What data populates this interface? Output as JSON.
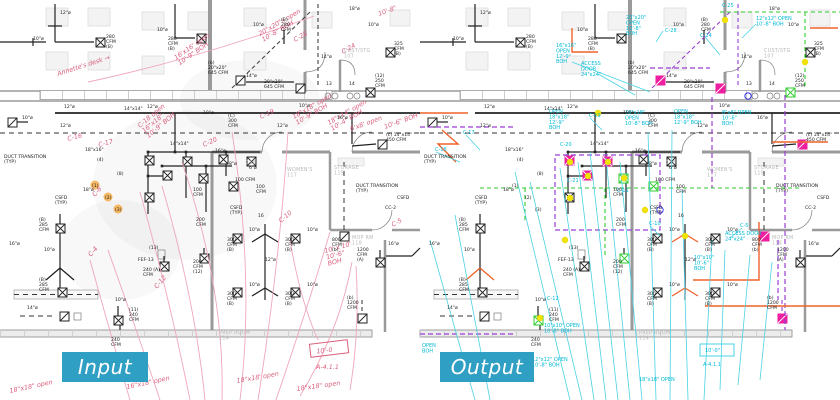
{
  "badges": {
    "input": "Input",
    "output": "Output"
  },
  "accent_color": "#2f9fc4",
  "palette": {
    "cyan": "#00b9d6",
    "magenta": "#ee1ea0",
    "green": "#2ecc2e",
    "purple": "#9a3fd4",
    "orange": "#f0622a",
    "yellow": "#f2e400",
    "markup_red": "#d95f7d",
    "walls_gray": "#9a9a9a"
  },
  "input_box_note": {
    "line1": "10'-0",
    "line2": "A-4.1.1"
  },
  "output_box_note": {
    "line1": "10'-0\"",
    "line2": "A-4.1.1"
  },
  "plan_labels": [
    {
      "x": 60,
      "y": 14,
      "t": "12\"ø"
    },
    {
      "x": 33,
      "y": 40,
      "t": "10\"ø"
    },
    {
      "x": 106,
      "y": 38,
      "t": "280\nCFM\n(B)"
    },
    {
      "x": 157,
      "y": 31,
      "t": "10\"ø"
    },
    {
      "x": 168,
      "y": 40,
      "t": "280\nCFM\n(B)"
    },
    {
      "x": 253,
      "y": 26,
      "t": "10\"ø"
    },
    {
      "x": 281,
      "y": 21,
      "t": "(B)\n280\nCFM"
    },
    {
      "x": 349,
      "y": 10,
      "t": "18\"ø"
    },
    {
      "x": 208,
      "y": 64,
      "t": "(b)\n20\"x20\"\n645 CFM"
    },
    {
      "x": 264,
      "y": 83,
      "t": "20\"x20\"\n645 CFM"
    },
    {
      "x": 246,
      "y": 77,
      "t": "14\"ø"
    },
    {
      "x": 321,
      "y": 58,
      "t": "14\"ø"
    },
    {
      "x": 394,
      "y": 45,
      "t": "325\nCFM\n(B)"
    },
    {
      "x": 375,
      "y": 77,
      "t": "(12)\n250\nCFM"
    },
    {
      "x": 326,
      "y": 85,
      "t": "13"
    },
    {
      "x": 349,
      "y": 85,
      "t": "14"
    },
    {
      "x": 368,
      "y": 26,
      "t": "10\"ø"
    },
    {
      "x": 344,
      "y": 52,
      "t": "CUST/STG\n107",
      "c": "rm"
    },
    {
      "x": 64,
      "y": 108,
      "t": "12\"ø"
    },
    {
      "x": 147,
      "y": 108,
      "t": "12\"ø"
    },
    {
      "x": 60,
      "y": 127,
      "t": "12\"ø"
    },
    {
      "x": 22,
      "y": 119,
      "t": "10\"ø"
    },
    {
      "x": 124,
      "y": 110,
      "t": "14\"x14\""
    },
    {
      "x": 203,
      "y": 114,
      "t": "10\"ø"
    },
    {
      "x": 228,
      "y": 117,
      "t": "(C)\n300\nCFM"
    },
    {
      "x": 277,
      "y": 127,
      "t": "12\"ø"
    },
    {
      "x": 299,
      "y": 107,
      "t": "10\"ø"
    },
    {
      "x": 337,
      "y": 119,
      "t": "16\"ø"
    },
    {
      "x": 386,
      "y": 136,
      "t": "(c) 14\"x14\"\n450 CFM"
    },
    {
      "x": 4,
      "y": 158,
      "t": "DUCT TRANSITION\n(TYP)"
    },
    {
      "x": 85,
      "y": 151,
      "t": "18\"x16\""
    },
    {
      "x": 170,
      "y": 145,
      "t": "14\"x14\""
    },
    {
      "x": 356,
      "y": 187,
      "t": "DUCT TRANSITION\n(TYP)"
    },
    {
      "x": 334,
      "y": 169,
      "t": "STORAGE\n115",
      "c": "rm"
    },
    {
      "x": 287,
      "y": 171,
      "t": "WOMEN'S\n117",
      "c": "rm"
    },
    {
      "x": 246,
      "y": 164,
      "t": "116",
      "c": "rm"
    },
    {
      "x": 55,
      "y": 199,
      "t": "CSFD\n(TYP)"
    },
    {
      "x": 230,
      "y": 209,
      "t": "CSFD\n(TYP)"
    },
    {
      "x": 258,
      "y": 217,
      "t": "16"
    },
    {
      "x": 397,
      "y": 199,
      "t": "CSFD"
    },
    {
      "x": 385,
      "y": 209,
      "t": "CC-2"
    },
    {
      "x": 215,
      "y": 152,
      "t": "16\"ø"
    },
    {
      "x": 229,
      "y": 165,
      "t": "8\"ø"
    },
    {
      "x": 249,
      "y": 169,
      "t": "6\"ø"
    },
    {
      "x": 235,
      "y": 181,
      "t": "100 CFM"
    },
    {
      "x": 256,
      "y": 188,
      "t": "100\nCFM"
    },
    {
      "x": 193,
      "y": 191,
      "t": "100\nCFM"
    },
    {
      "x": 138,
      "y": 261,
      "t": "FEF-13"
    },
    {
      "x": 39,
      "y": 221,
      "t": "(B)\n285\nCFM"
    },
    {
      "x": 44,
      "y": 251,
      "t": "10\"ø"
    },
    {
      "x": 9,
      "y": 245,
      "t": "16\"ø"
    },
    {
      "x": 39,
      "y": 281,
      "t": "(B)\n285\nCFM"
    },
    {
      "x": 83,
      "y": 191,
      "t": "18\"ø"
    },
    {
      "x": 27,
      "y": 309,
      "t": "14\"ø"
    },
    {
      "x": 115,
      "y": 301,
      "t": "10\"ø"
    },
    {
      "x": 129,
      "y": 311,
      "t": "(11)\n240\nCFM"
    },
    {
      "x": 111,
      "y": 341,
      "t": "240\nCFM"
    },
    {
      "x": 143,
      "y": 271,
      "t": "240 (A)\nCFM"
    },
    {
      "x": 193,
      "y": 263,
      "t": "200\nCFM\n(12)"
    },
    {
      "x": 196,
      "y": 221,
      "t": "200\nCFM"
    },
    {
      "x": 227,
      "y": 241,
      "t": "300\nCFM\n(B)"
    },
    {
      "x": 285,
      "y": 241,
      "t": "300\nCFM\n(B)"
    },
    {
      "x": 227,
      "y": 295,
      "t": "300\nCFM\n(B)"
    },
    {
      "x": 285,
      "y": 295,
      "t": "300\nCFM\n(B)"
    },
    {
      "x": 249,
      "y": 231,
      "t": "10\"ø"
    },
    {
      "x": 307,
      "y": 231,
      "t": "10\"ø"
    },
    {
      "x": 249,
      "y": 286,
      "t": "10\"ø"
    },
    {
      "x": 307,
      "y": 286,
      "t": "10\"ø"
    },
    {
      "x": 265,
      "y": 261,
      "t": "12\"ø"
    },
    {
      "x": 332,
      "y": 241,
      "t": "800\nCFM\n(b)"
    },
    {
      "x": 352,
      "y": 239,
      "t": "MOP RM\n118",
      "c": "rm"
    },
    {
      "x": 357,
      "y": 251,
      "t": "1200\nCFM\n(A)"
    },
    {
      "x": 388,
      "y": 245,
      "t": "16\"ø"
    },
    {
      "x": 347,
      "y": 299,
      "t": "(b)\n1200\nCFM"
    },
    {
      "x": 219,
      "y": 334,
      "t": "PREP ROOM\n114",
      "c": "rm"
    },
    {
      "x": 97,
      "y": 161,
      "t": "(4)"
    },
    {
      "x": 117,
      "y": 175,
      "t": "(8)"
    },
    {
      "x": 92,
      "y": 187,
      "t": "(1)"
    },
    {
      "x": 105,
      "y": 199,
      "t": "(2)"
    },
    {
      "x": 115,
      "y": 211,
      "t": "(3)"
    },
    {
      "x": 149,
      "y": 249,
      "t": "(13)"
    }
  ],
  "input_markup_notes": [
    {
      "x": 58,
      "y": 76,
      "t": "Annette's desk →",
      "r": -18
    },
    {
      "x": 176,
      "y": 60,
      "t": "16'x16' open\n10'-9\" BOH",
      "r": -35
    },
    {
      "x": 260,
      "y": 36,
      "t": "20\"x20\"s open\n10'-8\" BOH",
      "r": -30
    },
    {
      "x": 295,
      "y": 42,
      "t": "C-28",
      "r": -30
    },
    {
      "x": 343,
      "y": 54,
      "t": "C-24",
      "r": -30
    },
    {
      "x": 379,
      "y": 16,
      "t": "10'-8\"",
      "r": -20
    },
    {
      "x": 140,
      "y": 128,
      "t": "C-18 open\n16\"x18\"\n10'-9\" BOH",
      "r": -40
    },
    {
      "x": 261,
      "y": 119,
      "t": "C-19",
      "r": -25
    },
    {
      "x": 294,
      "y": 119,
      "t": "18\"x18\" open\n10'-9\" BOH",
      "r": -30
    },
    {
      "x": 329,
      "y": 125,
      "t": "18\"x14\" open\n10'-4\" BOH",
      "r": -30
    },
    {
      "x": 351,
      "y": 131,
      "t": "6'x8' open",
      "r": -20
    },
    {
      "x": 385,
      "y": 129,
      "t": "10'-6\" BOH",
      "r": -20
    },
    {
      "x": 68,
      "y": 141,
      "t": "C-16",
      "r": -15
    },
    {
      "x": 99,
      "y": 147,
      "t": "C-17",
      "r": -15
    },
    {
      "x": 204,
      "y": 147,
      "t": "C-20",
      "r": -25
    },
    {
      "x": 95,
      "y": 197,
      "t": "C-8",
      "r": -50
    },
    {
      "x": 91,
      "y": 257,
      "t": "C-4",
      "r": -50
    },
    {
      "x": 157,
      "y": 289,
      "t": "C-12",
      "r": -50
    },
    {
      "x": 281,
      "y": 223,
      "t": "C-10",
      "r": -40
    },
    {
      "x": 393,
      "y": 227,
      "t": "C-5",
      "r": -30
    },
    {
      "x": 325,
      "y": 253,
      "t": "10' x 10'\n10'-6\"\nBOH",
      "r": -15
    },
    {
      "x": 237,
      "y": 383,
      "t": "18\"x18' open",
      "r": -10
    },
    {
      "x": 297,
      "y": 391,
      "t": "18\"x18\" open",
      "r": -8
    },
    {
      "x": 127,
      "y": 389,
      "t": "16\"x18\" open",
      "r": -12
    },
    {
      "x": 10,
      "y": 393,
      "t": "18\"x18\" open",
      "r": -12
    }
  ],
  "output_cad_notes": [
    {
      "x": 136,
      "y": 47,
      "t": "16\"x16\"\nOPEN\n12'-9\"\nBOH"
    },
    {
      "x": 161,
      "y": 65,
      "t": "ACCESS\nDOOR\n24\"x24\""
    },
    {
      "x": 206,
      "y": 19,
      "t": "20\"x20\"\nOPEN\n10'-8\"\nBOH"
    },
    {
      "x": 245,
      "y": 32,
      "t": "C-28"
    },
    {
      "x": 280,
      "y": 37,
      "t": "C-24"
    },
    {
      "x": 302,
      "y": 7,
      "t": "C-25"
    },
    {
      "x": 336,
      "y": 20,
      "t": "12\"x12\" OPEN\n10'-8\" BOH"
    },
    {
      "x": 129,
      "y": 113,
      "t": "OPEN\n18\"x18\"\n12'-9\"\nBOH"
    },
    {
      "x": 169,
      "y": 117,
      "t": "C-19"
    },
    {
      "x": 205,
      "y": 114,
      "t": "18\"x18\"\nOPEN\n10'-8\" BOH"
    },
    {
      "x": 254,
      "y": 113,
      "t": "OPEN\n18\"x18\"\n12'-9\" BOH"
    },
    {
      "x": 302,
      "y": 114,
      "t": "8\"x8\" OPEN\n10'-6\"\nBOH"
    },
    {
      "x": 15,
      "y": 151,
      "t": "C-16"
    },
    {
      "x": 43,
      "y": 134,
      "t": "C-17"
    },
    {
      "x": 140,
      "y": 146,
      "t": "C-20"
    },
    {
      "x": 147,
      "y": 182,
      "t": "C-21"
    },
    {
      "x": 197,
      "y": 192,
      "t": "C-11"
    },
    {
      "x": 229,
      "y": 225,
      "t": "C-10"
    },
    {
      "x": 127,
      "y": 300,
      "t": "C-12"
    },
    {
      "x": 320,
      "y": 227,
      "t": "C-5"
    },
    {
      "x": 305,
      "y": 235,
      "t": "ACCESS DOOR\n24\"x24\""
    },
    {
      "x": 274,
      "y": 259,
      "t": "10\"x10\"\n10'-6\"\nBOH"
    },
    {
      "x": 124,
      "y": 327,
      "t": "10\"x10\" OPEN\n10'-8\" BOH"
    },
    {
      "x": 112,
      "y": 361,
      "t": "12\"x12\" OPEN\n10'-8\" BOH"
    },
    {
      "x": 219,
      "y": 381,
      "t": "18\"x18\" OPEN"
    },
    {
      "x": 2,
      "y": 347,
      "t": "OPEN\nBOH"
    },
    {
      "x": 21,
      "y": 375,
      "t": "24\"x24\""
    }
  ]
}
